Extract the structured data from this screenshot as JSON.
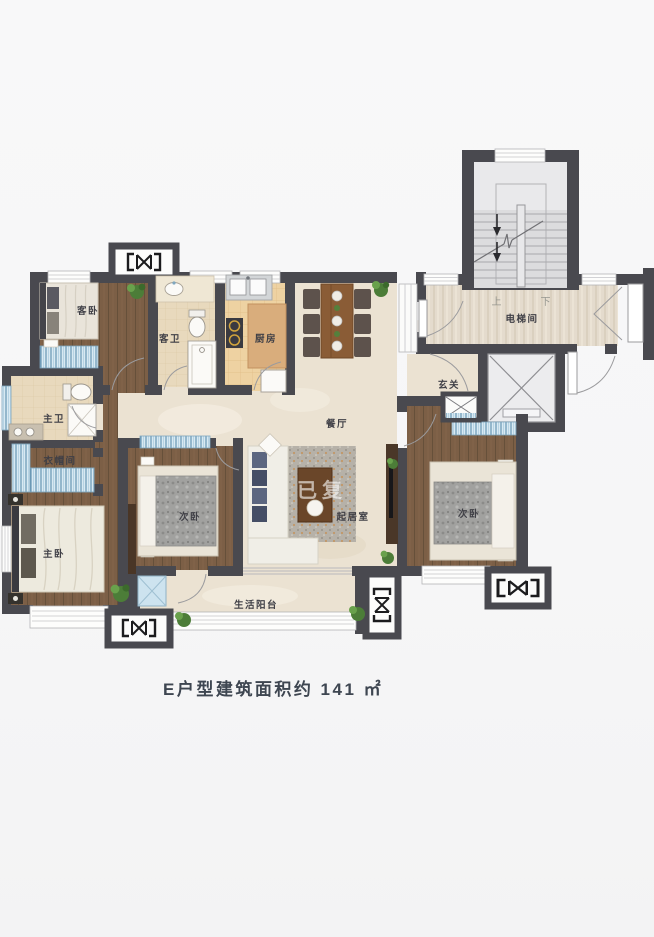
{
  "plan": {
    "caption": {
      "text": "E户型建筑面积约 141 ㎡"
    },
    "watermark": "已复",
    "rooms": {
      "guest_bedroom": "客卧",
      "guest_bathroom": "客卫",
      "kitchen": "厨房",
      "dining_room": "餐厅",
      "foyer": "玄关",
      "elevator_hall": "电梯间",
      "master_bathroom": "主卫",
      "cloakroom": "衣帽间",
      "master_bedroom": "主卧",
      "second_bedroom": "次卧",
      "living_room": "起居室",
      "third_bedroom": "次卧",
      "balcony": "生活阳台"
    },
    "stairs": {
      "up": "上",
      "down": "下"
    },
    "colors": {
      "wall": "#49494f",
      "wood_floor": "#7c5f46",
      "marble_floor": "#ebe2d2",
      "window_blue": "#d8e9f2",
      "caption_text": "#3e4651"
    }
  }
}
